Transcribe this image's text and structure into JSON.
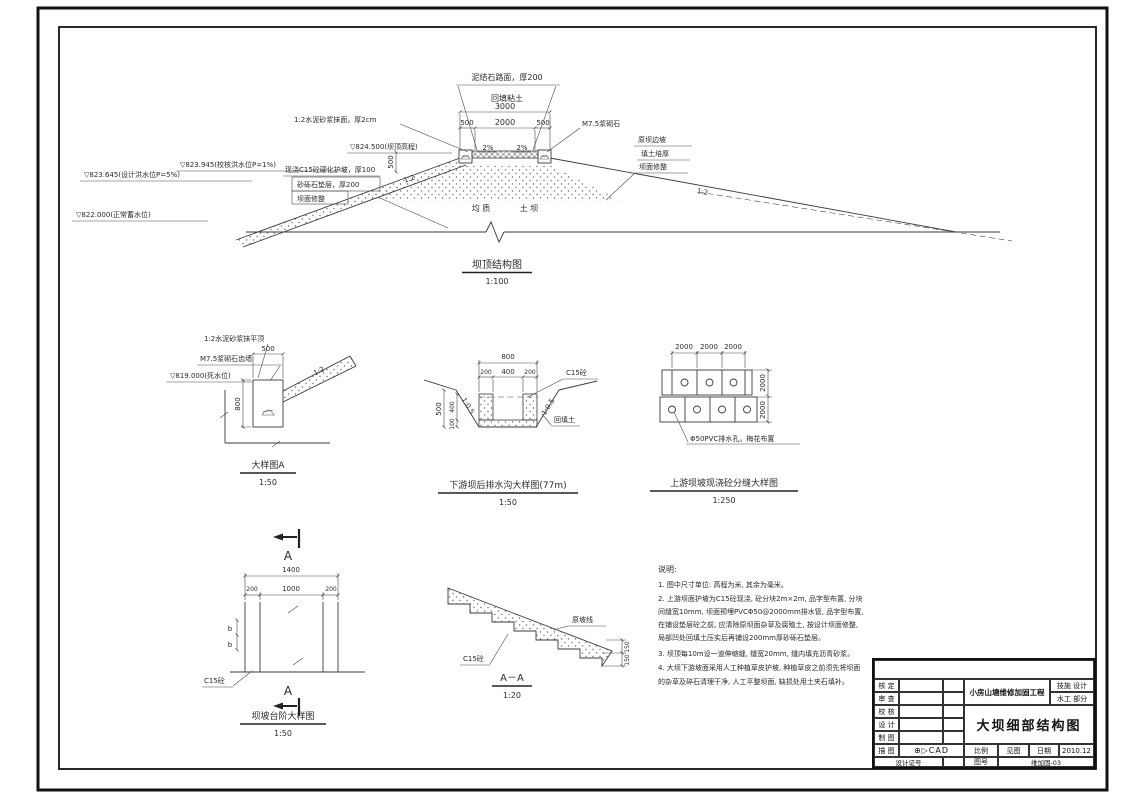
{
  "cross_section": {
    "title": "坝顶结构图",
    "scale": "1:100",
    "road_label": "泥结石路面，厚200",
    "backfill_label": "回填粘土",
    "dim_3000": "3000",
    "dim_500L": "500",
    "dim_2000": "2000",
    "dim_500R": "500",
    "dim_500V": "500",
    "mortar_label": "1:2水泥砂浆抹面，厚2cm",
    "masonry_label": "M7.5浆砌石",
    "crest_elev": "▽824.500(坝顶高程)",
    "check_flood": "▽823.945(校核洪水位P=1%)",
    "design_flood": "▽823.645(设计洪水位P=5%)",
    "normal_level": "▽822.000(正常蓄水位)",
    "c15_label": "现浇C15砼硬化护坡，厚100",
    "cushion_label": "砂砾石垫层，厚200",
    "trim_label": "坝面修整",
    "orig_slope_label": "原坝边坡",
    "fill_label": "填土培厚",
    "trim2_label": "坝面修整",
    "body_label_1": "均 质",
    "body_label_2": "土 坝",
    "slope_left": "1:2",
    "slope_right": "1:2",
    "pct_left": "2%",
    "pct_right": "2%"
  },
  "detail_a": {
    "title": "大样图A",
    "scale": "1:50",
    "mortar_top": "1:2水泥砂浆抹平顶",
    "masonry_wall": "M7.5浆砌石齿墙",
    "dead_level": "▽819.000(死水位)",
    "dim_500": "500",
    "dim_800": "800",
    "slope": "1:2"
  },
  "drain": {
    "title": "下游坝后排水沟大样图(77m)",
    "scale": "1:50",
    "dim_800": "800",
    "dim_200a": "200",
    "dim_400": "400",
    "dim_200b": "200",
    "dim_500": "500",
    "dim_400v": "400",
    "dim_100": "100",
    "slope_l": "1:0.5",
    "slope_r": "1:0.5",
    "c15": "C15砼",
    "backfill": "回填土"
  },
  "joint": {
    "title": "上游坝坡现浇砼分缝大样图",
    "scale": "1:250",
    "dim_2000a": "2000",
    "dim_2000b": "2000",
    "dim_2000c": "2000",
    "dim_2000r1": "2000",
    "dim_2000r2": "2000",
    "pvc_label": "Φ50PVC排水孔，梅花布置"
  },
  "steps_plan": {
    "title": "坝坡台阶大样图",
    "scale": "1:50",
    "section_letter_top": "A",
    "section_letter_bottom": "A",
    "dim_1400": "1400",
    "dim_200a": "200",
    "dim_1000": "1000",
    "dim_200b": "200",
    "dim_b1": "b",
    "dim_b2": "b",
    "c15": "C15砼"
  },
  "steps_section": {
    "title": "A－A",
    "scale": "1:20",
    "orig_line": "原坡线",
    "c15": "C15砼",
    "dim_150a": "150",
    "dim_150b": "150"
  },
  "notes": {
    "heading": "说明:",
    "lines": [
      "1. 图中尺寸单位: 高程为米, 其余为毫米。",
      "2. 上游坝面护坡为C15砼现浇, 砼分块2m×2m, 品字型布置, 分块",
      "间缝宽10mm, 坝面预埋PVCΦ50@2000mm排水管, 品字型布置,",
      "在铺设垫层砼之前, 应清除原坝面杂草及腐殖土, 按设计坝面修整,",
      "局部凹处回填土压实后再铺设200mm厚砂砾石垫层。",
      "3. 坝顶每10m设一道伸缩缝, 缝宽20mm, 缝内填充沥青砂浆。",
      "4. 大坝下游坡面采用人工种植草皮护坡, 种植草皮之前须先将坝面",
      "的杂草及碎石清理干净, 人工平整坝面, 缺损处用土夹石填补。"
    ]
  },
  "title_block": {
    "rows": [
      {
        "label": "核 定"
      },
      {
        "label": "审 查"
      },
      {
        "label": "校 核"
      },
      {
        "label": "设 计"
      },
      {
        "label": "制 图"
      },
      {
        "label": "描 图"
      },
      {
        "label": "设计证号"
      }
    ],
    "project": "小房山塘维修加固工程",
    "stage": "技施 设计",
    "part": "水工 部分",
    "drawing_title": "大坝细部结构图",
    "cad_logo": "⊕▷CAD",
    "scale_label": "比例",
    "scale_value": "见图",
    "date_label": "日期",
    "date_value": "2010.12",
    "no_label": "图号",
    "no_value": "维加固-03"
  }
}
